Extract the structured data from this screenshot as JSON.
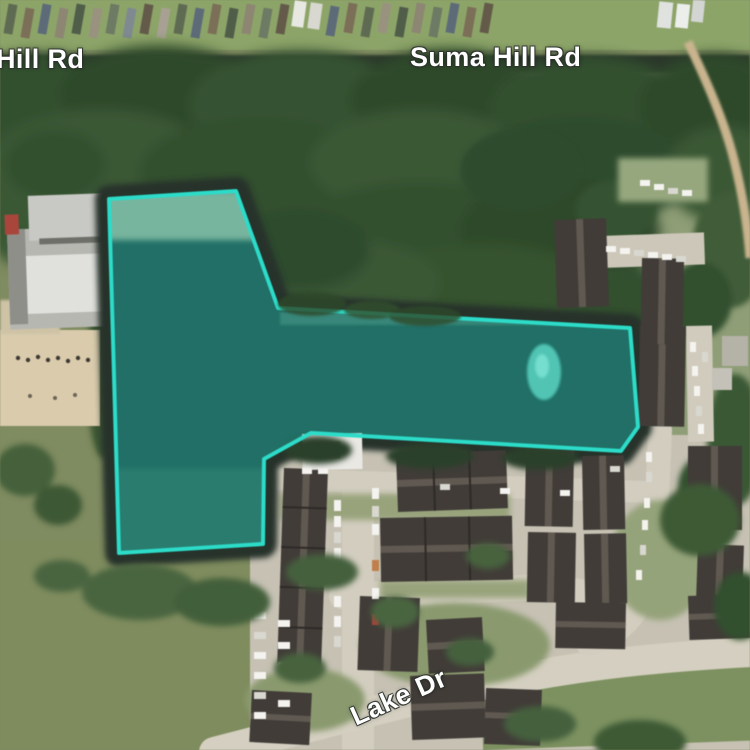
{
  "map": {
    "view": "satellite",
    "labels": {
      "road_left": "Hill Rd",
      "road_top": "Suma Hill Rd",
      "road_bottom": "Lake Dr"
    },
    "parcel": {
      "points": "109,199 236,191 278,308 630,328 638,427 621,451 311,433 264,459 263,544 119,553",
      "stroke_color": "#2cdcc9",
      "fill_color": "rgba(44,226,205,0.26)",
      "stroke_width": "4"
    },
    "colors": {
      "highlight": "#2cdcc9",
      "water_dark": "#1e4843",
      "forest": "#33502f",
      "field": "#7f8b60",
      "pavement": "#d2cdbf",
      "label_text": "#ffffff"
    }
  }
}
